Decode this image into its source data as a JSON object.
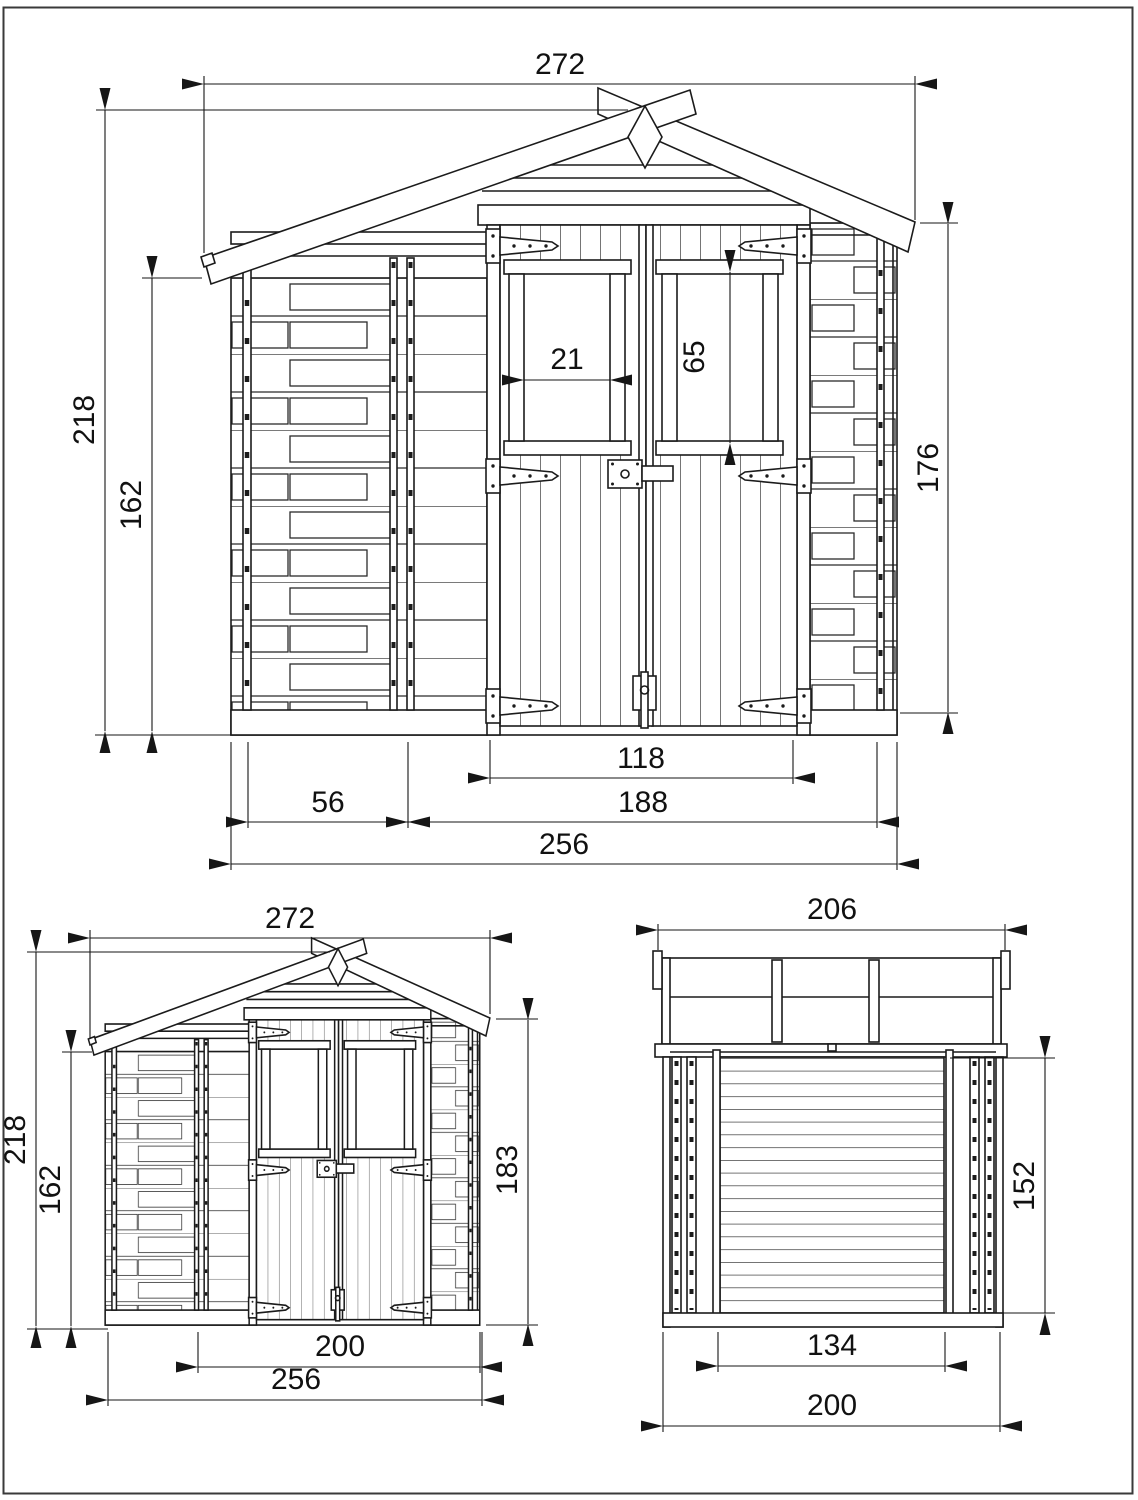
{
  "style": {
    "line_color": "#1b1b1b",
    "background": "#ffffff"
  },
  "views": {
    "front": {
      "name": "front-elevation-large",
      "dims": {
        "roof_width": "272",
        "overall_height": "218",
        "wall_height": "162",
        "window_width": "21",
        "window_height": "65",
        "eave_height": "176",
        "door_width": "118",
        "opening_width": "188",
        "side_panel_width": "56",
        "base_width": "256"
      }
    },
    "front_small": {
      "name": "front-elevation-small",
      "dims": {
        "roof_width": "272",
        "overall_height": "218",
        "wall_height": "162",
        "door_height": "183",
        "frame_width": "200",
        "base_width": "256"
      }
    },
    "side": {
      "name": "side-elevation",
      "dims": {
        "roof_depth": "206",
        "wall_height": "152",
        "inner_depth": "134",
        "base_depth": "200"
      }
    }
  }
}
